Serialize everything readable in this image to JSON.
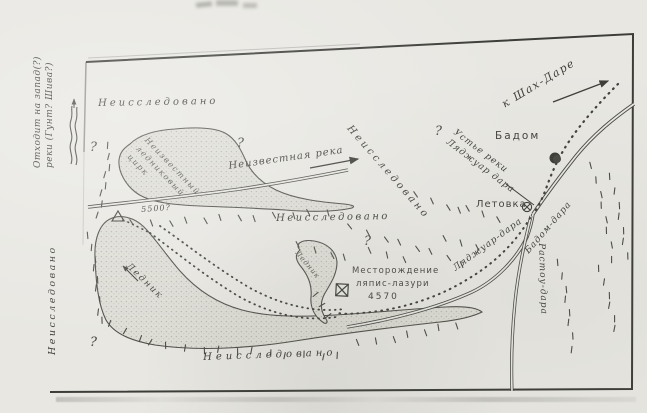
{
  "map": {
    "colors": {
      "paper": "#e8e7e2",
      "ink": "#3f3f3a",
      "frame": "#3c3c38"
    },
    "margin": {
      "note_lines": [
        "Отходит на запад(?)",
        "реки (Гунт? Шива?)"
      ],
      "unexplored_side": "Неисследовано"
    },
    "unexplored": {
      "top": "Неисследовано",
      "diagonal": "Неисследовано",
      "center": "Неисследовано",
      "bottom": "Неисследовано"
    },
    "cirque_lines": [
      "Неизвестный",
      "ледниковый",
      "цирк"
    ],
    "unknown_river": "Неизвестная река",
    "glaciers": {
      "big": "Ледник",
      "small": "Ледник",
      "pass_elevation": "5500?"
    },
    "deposit": {
      "line1": "Месторождение",
      "line2": "ляпис-лазури",
      "elevation": "4570"
    },
    "settlements": {
      "village": "Бадом",
      "camp": "Летовка"
    },
    "rivers": {
      "badom_dara": "Бадом-дара",
      "ljadzhuar_dara": "Ляджуар-дара",
      "rastou_dara": "Растоу-дара"
    },
    "mouth_lines": [
      "Устье реки",
      "Ляджуар дара"
    ],
    "direction": {
      "to_shahdara": "к Шах-Даре"
    },
    "question_mark": "?"
  }
}
